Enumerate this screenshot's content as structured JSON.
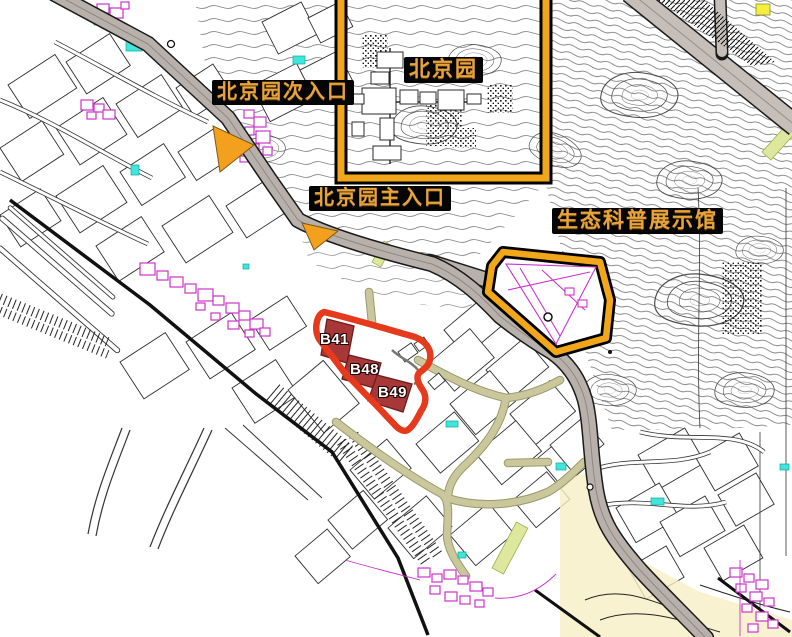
{
  "map": {
    "region_labels": {
      "garden": "北京园",
      "secondary_entrance": "北京园次入口",
      "main_entrance": "北京园主入口",
      "eco_exhibition_hall": "生态科普展示馆"
    },
    "building_labels": [
      "B41",
      "B48",
      "B49"
    ],
    "icons": {
      "entrance_marker": "orange-triangle-arrow"
    },
    "colors": {
      "highlight_orange": "#F2A71B",
      "label_text_orange": "#E8A33D",
      "label_background": "#050505",
      "selection_red": "#E63A1C",
      "building_fill_darkred": "#A83838",
      "road_gray": "#B8B0AA",
      "path_khaki": "#C9C79B",
      "detail_magenta": "#CC33CC",
      "accent_cyan": "#41E5DC",
      "zone_pale_yellow": "#F6EFC5",
      "strip_pale_green": "#DDE79E"
    }
  }
}
